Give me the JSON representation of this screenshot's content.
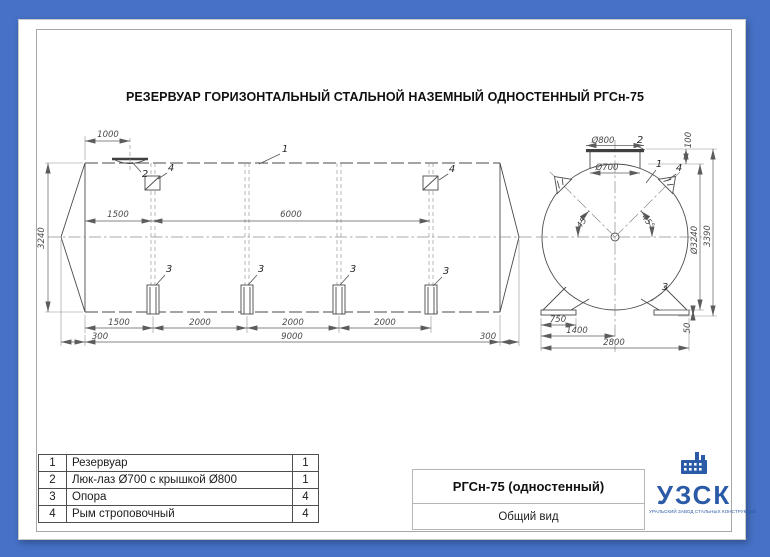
{
  "window": {
    "background_color": "#4671c6"
  },
  "sheet": {
    "title": "РЕЗЕРВУАР ГОРИЗОНТАЛЬНЫЙ СТАЛЬНОЙ НАЗЕМНЫЙ ОДНОСТЕННЫЙ РГСн-75"
  },
  "side_view": {
    "dims": {
      "d1000": "1000",
      "d1500a": "1500",
      "d6000": "6000",
      "d3240": "3240",
      "d1500b": "1500",
      "d2000a": "2000",
      "d2000b": "2000",
      "d2000c": "2000",
      "d300a": "300",
      "d9000": "9000",
      "d300b": "300"
    }
  },
  "end_view": {
    "dims": {
      "d800": "Ø800",
      "d700": "Ø700",
      "d100": "100",
      "d3240": "Ø3240",
      "d3390": "3390",
      "d50": "50",
      "d750": "750",
      "d1400": "1400",
      "d2800": "2800",
      "a45l": "45°",
      "a45r": "45°"
    }
  },
  "callouts": {
    "n1": "1",
    "n2": "2",
    "n3": "3",
    "n4": "4"
  },
  "parts_table": {
    "rows": [
      {
        "num": "1",
        "name": "Резервуар",
        "qty": "1"
      },
      {
        "num": "2",
        "name": "Люк-лаз Ø700 с крышкой Ø800",
        "qty": "1"
      },
      {
        "num": "3",
        "name": "Опора",
        "qty": "4"
      },
      {
        "num": "4",
        "name": "Рым строповочный",
        "qty": "4"
      }
    ]
  },
  "title_block": {
    "model": "РГСн-75 (одностенный)",
    "view_name": "Общий вид"
  },
  "logo": {
    "text": "УЗСК",
    "tagline": "УРАЛЬСКИЙ ЗАВОД СТАЛЬНЫХ КОНСТРУКЦИЙ",
    "color": "#2b5aa7"
  }
}
